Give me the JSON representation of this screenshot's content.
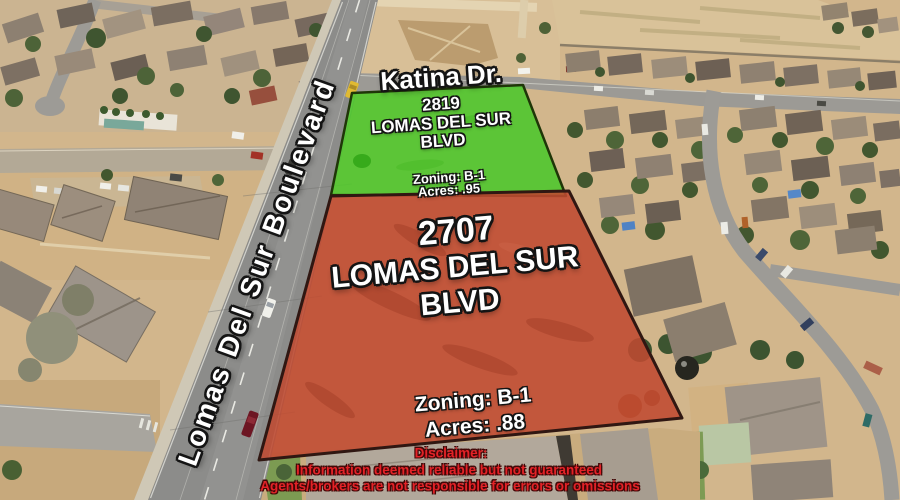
{
  "listing": {
    "main_road": "Lomas Del Sur Boulevard",
    "cross_street": "Katina Dr.",
    "parcels": [
      {
        "id": "2819",
        "address_number": "2819",
        "street": "LOMAS DEL SUR",
        "street_suffix": "BLVD",
        "zoning": "Zoning: B-1",
        "acres": "Acres: .95",
        "overlay_color": "#4fc72d"
      },
      {
        "id": "2707",
        "address_number": "2707",
        "street": "LOMAS DEL SUR",
        "street_suffix": "BLVD",
        "zoning": "Zoning: B-1",
        "acres": "Acres: .88",
        "overlay_color": "#bf4a31"
      }
    ],
    "disclaimer": {
      "title": "Disclaimer:",
      "line1": "Information deemed reliable but not guaranteed",
      "line2": "Agents/brokers are not responsible for errors or omissions",
      "text_color": "#e32227"
    }
  }
}
